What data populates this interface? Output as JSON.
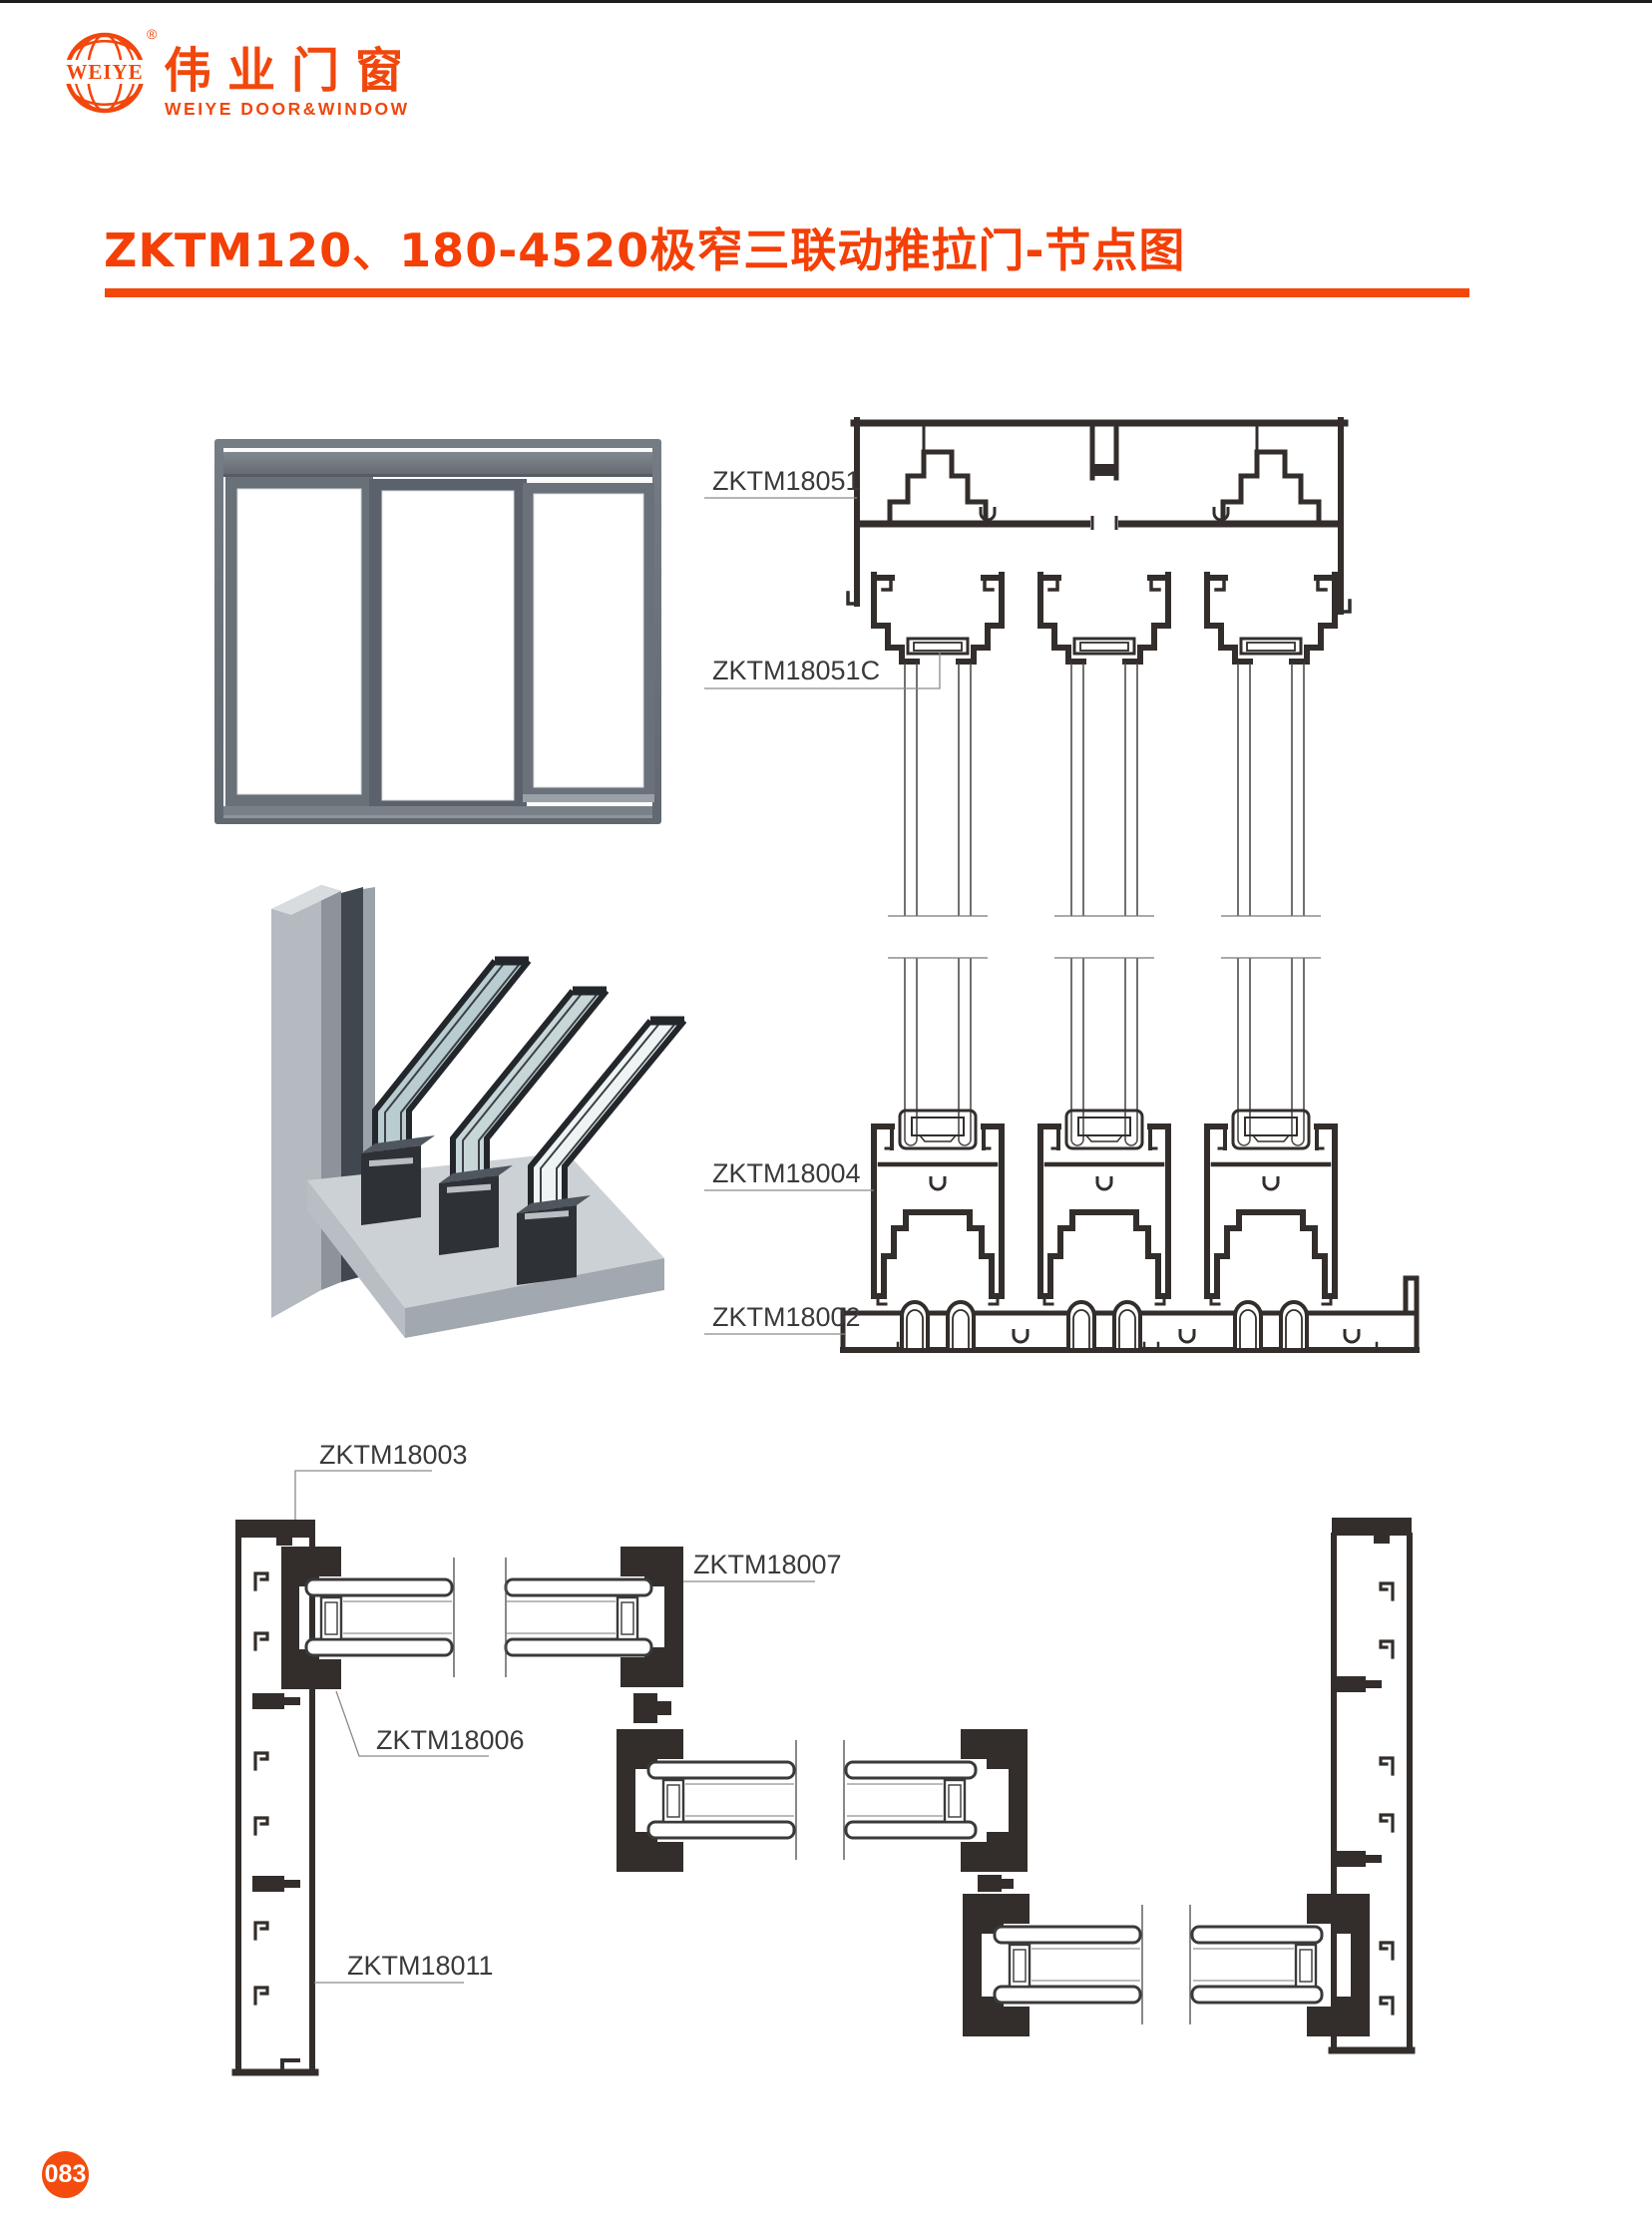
{
  "logo": {
    "globe_text": "WEIYE",
    "registered": "®",
    "name_cn": "伟业门窗",
    "name_en": "WEIYE DOOR&WINDOW"
  },
  "title": "ZKTM120、180-4520极窄三联动推拉门-节点图",
  "sections": {
    "vertical": {
      "labels": {
        "head_track": "ZKTM18051",
        "top_hanger": "ZKTM18051C",
        "bottom_rail": "ZKTM18004",
        "bottom_track": "ZKTM18002"
      }
    },
    "horizontal": {
      "labels": {
        "frame_cap": "ZKTM18003",
        "interlock": "ZKTM18007",
        "glazing_channel": "ZKTM18006",
        "side_frame": "ZKTM18011"
      }
    }
  },
  "footer": {
    "page_number": "083"
  },
  "colors": {
    "accent": "#f4470a",
    "drawing_line": "#332e2b",
    "leader_line": "#8a8a8a",
    "label_text": "#3a3a3a"
  }
}
